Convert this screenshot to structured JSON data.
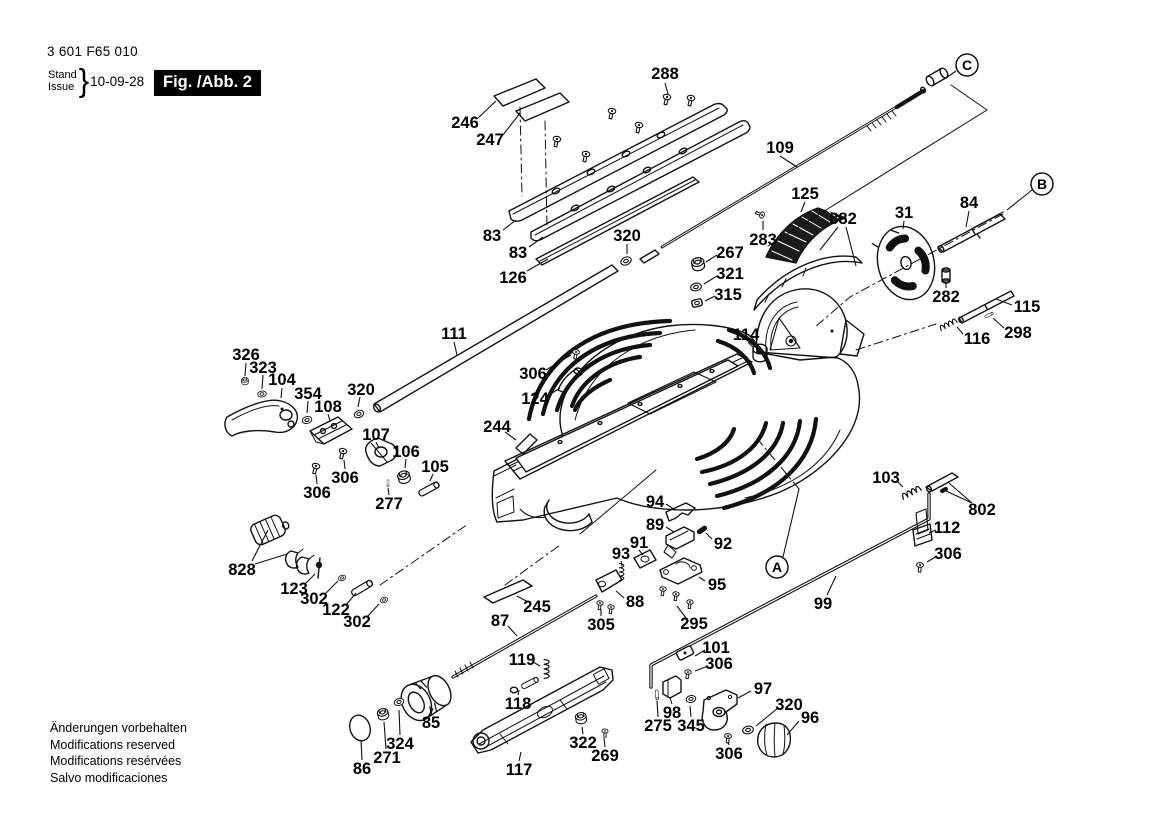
{
  "header": {
    "part_no": "3 601 F65 010",
    "stand_label": "Stand",
    "issue_label": "Issue",
    "brace": "}",
    "date": "10-09-28",
    "fig_label": "Fig. /Abb. 2"
  },
  "footer": {
    "lines": [
      "Änderungen vorbehalten",
      "Modifications reserved",
      "Modifications resérvées",
      "Salvo modificaciones"
    ]
  },
  "colors": {
    "ink": "#111111",
    "paper": "#ffffff"
  },
  "callouts": [
    {
      "letter": "C",
      "x": 967,
      "y": 65,
      "leader": [
        956,
        71,
        946,
        78
      ]
    },
    {
      "letter": "B",
      "x": 1042,
      "y": 184,
      "leader": [
        1032,
        190,
        1007,
        210
      ]
    },
    {
      "letter": "A",
      "x": 777,
      "y": 567,
      "leader": [
        783,
        557,
        799,
        489
      ]
    }
  ],
  "part_labels": [
    {
      "text": "288",
      "x": 665,
      "y": 73,
      "leader": [
        665,
        83,
        668,
        94
      ]
    },
    {
      "text": "246",
      "x": 465,
      "y": 122,
      "leader": [
        478,
        118,
        496,
        101
      ]
    },
    {
      "text": "247",
      "x": 490,
      "y": 139,
      "leader": [
        503,
        135,
        520,
        113
      ]
    },
    {
      "text": "83",
      "x": 492,
      "y": 235,
      "leader": [
        503,
        230,
        516,
        220
      ]
    },
    {
      "text": "83",
      "x": 518,
      "y": 252,
      "leader": [
        529,
        247,
        543,
        237
      ]
    },
    {
      "text": "126",
      "x": 513,
      "y": 277,
      "leader": [
        527,
        271,
        548,
        259
      ]
    },
    {
      "text": "320",
      "x": 627,
      "y": 235,
      "leader": [
        627,
        244,
        627,
        254
      ]
    },
    {
      "text": "109",
      "x": 780,
      "y": 147,
      "leader": [
        780,
        156,
        797,
        167
      ]
    },
    {
      "text": "125",
      "x": 805,
      "y": 193,
      "leader": [
        805,
        202,
        801,
        212
      ]
    },
    {
      "text": "882",
      "x": 843,
      "y": 218,
      "leader": [
        838,
        227,
        820,
        250
      ],
      "leader2": [
        846,
        227,
        856,
        266
      ]
    },
    {
      "text": "31",
      "x": 904,
      "y": 212,
      "leader": [
        904,
        221,
        903,
        229
      ]
    },
    {
      "text": "84",
      "x": 969,
      "y": 202,
      "leader": [
        969,
        211,
        966,
        227
      ]
    },
    {
      "text": "283",
      "x": 763,
      "y": 239,
      "leader": [
        763,
        230,
        763,
        221
      ]
    },
    {
      "text": "267",
      "x": 730,
      "y": 252,
      "leader": [
        717,
        255,
        706,
        262
      ]
    },
    {
      "text": "321",
      "x": 730,
      "y": 273,
      "leader": [
        717,
        276,
        704,
        284
      ]
    },
    {
      "text": "315",
      "x": 728,
      "y": 294,
      "leader": [
        715,
        296,
        705,
        301
      ]
    },
    {
      "text": "282",
      "x": 946,
      "y": 296,
      "leader": [
        946,
        288,
        946,
        282
      ]
    },
    {
      "text": "115",
      "x": 1027,
      "y": 306,
      "leader": [
        1012,
        305,
        996,
        299
      ]
    },
    {
      "text": "298",
      "x": 1018,
      "y": 332,
      "leader": [
        1004,
        328,
        993,
        318
      ]
    },
    {
      "text": "116",
      "x": 977,
      "y": 338,
      "leader": [
        963,
        334,
        957,
        327
      ]
    },
    {
      "text": "111",
      "x": 454,
      "y": 333,
      "leader": [
        454,
        342,
        457,
        355
      ]
    },
    {
      "text": "114",
      "x": 746,
      "y": 334,
      "leader": [
        748,
        342,
        754,
        348
      ]
    },
    {
      "text": "306",
      "x": 533,
      "y": 373,
      "leader": [
        546,
        370,
        571,
        355
      ]
    },
    {
      "text": "124",
      "x": 535,
      "y": 398,
      "leader": [
        549,
        395,
        560,
        388
      ]
    },
    {
      "text": "244",
      "x": 497,
      "y": 426,
      "leader": [
        505,
        432,
        516,
        440
      ]
    },
    {
      "text": "326",
      "x": 246,
      "y": 354,
      "leader": [
        246,
        363,
        245,
        376
      ]
    },
    {
      "text": "323",
      "x": 263,
      "y": 367,
      "leader": [
        263,
        375,
        262,
        389
      ]
    },
    {
      "text": "104",
      "x": 282,
      "y": 379,
      "leader": [
        282,
        388,
        281,
        398
      ]
    },
    {
      "text": "354",
      "x": 308,
      "y": 393,
      "leader": [
        308,
        401,
        307,
        413
      ]
    },
    {
      "text": "108",
      "x": 328,
      "y": 406,
      "leader": [
        328,
        414,
        330,
        421
      ]
    },
    {
      "text": "320",
      "x": 361,
      "y": 389,
      "leader": [
        360,
        397,
        358,
        407
      ]
    },
    {
      "text": "107",
      "x": 376,
      "y": 434,
      "leader": [
        376,
        442,
        379,
        448
      ]
    },
    {
      "text": "106",
      "x": 406,
      "y": 451,
      "leader": [
        406,
        459,
        405,
        468
      ]
    },
    {
      "text": "105",
      "x": 435,
      "y": 466,
      "leader": [
        433,
        474,
        430,
        481
      ]
    },
    {
      "text": "306",
      "x": 317,
      "y": 492,
      "leader": [
        317,
        484,
        316,
        475
      ]
    },
    {
      "text": "306",
      "x": 345,
      "y": 477,
      "leader": [
        345,
        469,
        344,
        460
      ]
    },
    {
      "text": "277",
      "x": 389,
      "y": 503,
      "leader": [
        389,
        495,
        388,
        488
      ]
    },
    {
      "text": "828",
      "x": 242,
      "y": 569,
      "leader": [
        252,
        561,
        268,
        530
      ],
      "leader2": [
        255,
        564,
        287,
        554
      ]
    },
    {
      "text": "123",
      "x": 294,
      "y": 588,
      "leader": [
        305,
        584,
        315,
        574
      ]
    },
    {
      "text": "302",
      "x": 314,
      "y": 598,
      "leader": [
        325,
        594,
        338,
        581
      ]
    },
    {
      "text": "122",
      "x": 336,
      "y": 609,
      "leader": [
        346,
        605,
        356,
        593
      ]
    },
    {
      "text": "302",
      "x": 357,
      "y": 621,
      "leader": [
        367,
        617,
        379,
        604
      ]
    },
    {
      "text": "94",
      "x": 655,
      "y": 501,
      "leader": [
        666,
        504,
        675,
        510
      ]
    },
    {
      "text": "89",
      "x": 655,
      "y": 524,
      "leader": [
        666,
        527,
        674,
        532
      ]
    },
    {
      "text": "92",
      "x": 723,
      "y": 543,
      "leader": [
        712,
        539,
        706,
        533
      ]
    },
    {
      "text": "91",
      "x": 639,
      "y": 542,
      "leader": [
        639,
        550,
        643,
        555
      ]
    },
    {
      "text": "93",
      "x": 621,
      "y": 553,
      "leader": [
        621,
        561,
        622,
        566
      ]
    },
    {
      "text": "95",
      "x": 717,
      "y": 584,
      "leader": [
        705,
        581,
        699,
        577
      ]
    },
    {
      "text": "88",
      "x": 635,
      "y": 601,
      "leader": [
        624,
        598,
        616,
        591
      ]
    },
    {
      "text": "305",
      "x": 601,
      "y": 624,
      "leader": [
        601,
        616,
        601,
        609
      ]
    },
    {
      "text": "295",
      "x": 694,
      "y": 623,
      "leader": [
        686,
        618,
        677,
        606
      ]
    },
    {
      "text": "99",
      "x": 823,
      "y": 603,
      "leader": [
        827,
        595,
        836,
        576
      ]
    },
    {
      "text": "103",
      "x": 886,
      "y": 477,
      "leader": [
        897,
        481,
        903,
        487
      ]
    },
    {
      "text": "802",
      "x": 982,
      "y": 509,
      "leader": [
        972,
        503,
        949,
        483
      ],
      "leader2": [
        972,
        503,
        946,
        491
      ]
    },
    {
      "text": "112",
      "x": 947,
      "y": 527,
      "leader": [
        936,
        530,
        929,
        533
      ]
    },
    {
      "text": "306",
      "x": 948,
      "y": 553,
      "leader": [
        937,
        556,
        927,
        562
      ]
    },
    {
      "text": "101",
      "x": 716,
      "y": 647,
      "leader": [
        705,
        650,
        695,
        656
      ]
    },
    {
      "text": "306",
      "x": 719,
      "y": 663,
      "leader": [
        708,
        666,
        695,
        671
      ]
    },
    {
      "text": "97",
      "x": 763,
      "y": 688,
      "leader": [
        751,
        691,
        738,
        698
      ]
    },
    {
      "text": "98",
      "x": 672,
      "y": 712,
      "leader": [
        672,
        704,
        670,
        698
      ]
    },
    {
      "text": "275",
      "x": 658,
      "y": 725,
      "leader": [
        658,
        717,
        657,
        701
      ]
    },
    {
      "text": "345",
      "x": 691,
      "y": 725,
      "leader": [
        691,
        717,
        690,
        706
      ]
    },
    {
      "text": "320",
      "x": 789,
      "y": 704,
      "leader": [
        778,
        708,
        756,
        726
      ]
    },
    {
      "text": "96",
      "x": 810,
      "y": 717,
      "leader": [
        799,
        721,
        787,
        735
      ]
    },
    {
      "text": "306",
      "x": 729,
      "y": 753,
      "leader": [
        729,
        745,
        728,
        742
      ]
    },
    {
      "text": "87",
      "x": 500,
      "y": 620,
      "leader": [
        508,
        626,
        517,
        636
      ]
    },
    {
      "text": "245",
      "x": 537,
      "y": 606,
      "leader": [
        528,
        602,
        517,
        596
      ]
    },
    {
      "text": "119",
      "x": 522,
      "y": 659,
      "leader": [
        533,
        662,
        540,
        666
      ]
    },
    {
      "text": "118",
      "x": 518,
      "y": 703,
      "leader": [
        518,
        695,
        519,
        690
      ]
    },
    {
      "text": "117",
      "x": 519,
      "y": 769,
      "leader": [
        519,
        761,
        521,
        752
      ]
    },
    {
      "text": "322",
      "x": 583,
      "y": 742,
      "leader": [
        583,
        734,
        582,
        727
      ]
    },
    {
      "text": "269",
      "x": 605,
      "y": 755,
      "leader": [
        605,
        747,
        604,
        738
      ]
    },
    {
      "text": "85",
      "x": 431,
      "y": 722,
      "leader": [
        431,
        714,
        433,
        708
      ]
    },
    {
      "text": "324",
      "x": 400,
      "y": 743,
      "leader": [
        400,
        735,
        399,
        710
      ]
    },
    {
      "text": "271",
      "x": 387,
      "y": 757,
      "leader": [
        386,
        749,
        384,
        722
      ]
    },
    {
      "text": "86",
      "x": 362,
      "y": 768,
      "leader": [
        362,
        760,
        361,
        740
      ]
    }
  ]
}
